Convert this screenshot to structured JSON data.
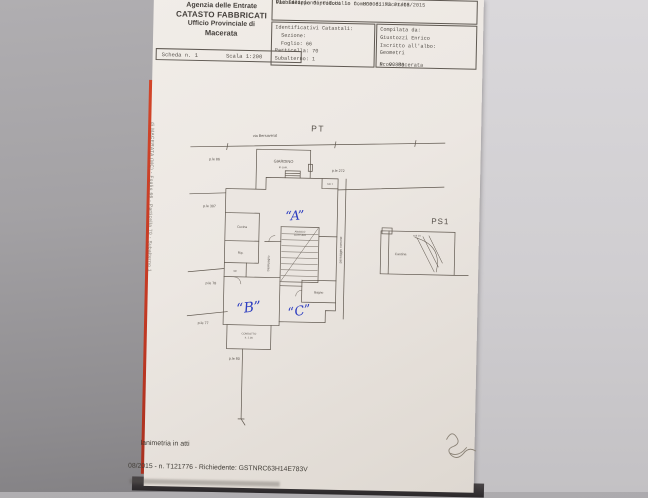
{
  "colors": {
    "red_folder": "#c43a24",
    "paper": "#ece7e2",
    "ink": "#56504a",
    "handwriting_blue": "#2c3dc0"
  },
  "header": {
    "agency": {
      "line1": "Agenzia delle Entrate",
      "line2": "CATASTO FABBRICATI",
      "line3": "Ufficio Provinciale di",
      "line4": "Macerata"
    },
    "scheda": {
      "sheet": "Scheda n. 1",
      "scale": "Scala 1:200"
    },
    "protocol": {
      "line1": "Dichiarazione protocollo n. MC0061173  21/08/2015",
      "line2": "Planimetria di U.I.U. in Comune di Macerata",
      "line3": "Via Filippo Corridoni",
      "variant": "var. 4"
    },
    "catasto": {
      "title": "Identificativi Catastali:",
      "sezione": "Sezione:",
      "foglio": "Foglio: 66",
      "particella": "Particella: 70",
      "subalterno": "Subalterno: 1"
    },
    "compiler": {
      "compilata": "Compilata da:",
      "name": "Giustozzi Enrico",
      "iscritto": "Iscritto all'albo:",
      "albo": "Geometri",
      "prov": "Prov. Macerata",
      "num": "N. 00800"
    }
  },
  "plan": {
    "pt": "PT",
    "ps1": "PS1",
    "street": "via Bersaverat",
    "giardino": "GIARDINO",
    "giardino_note": "in com.",
    "parcels": [
      "p.le 86",
      "p.le 272",
      "p.le 307",
      "p.le 78",
      "p.le 77",
      "p.le 80"
    ],
    "rooms": {
      "cucina": "Cucina",
      "rip": "Rip.",
      "wc": "wc",
      "disimpegno": "Disimpegno",
      "angolo_line1": "ANGOLO",
      "angolo_line2": "COTTURA",
      "bagno": "Bagno",
      "condotto_line1": "CONDOTTO",
      "condotto_line2": "h. 1.00",
      "cantina": "Cantina",
      "sub_small": "sub 1",
      "sub_ps1": "sub 10",
      "passaggio": "passaggio comune"
    },
    "marks": {
      "a": "“A”",
      "b": "“B”",
      "c": "“C”"
    }
  },
  "edge_note": "di MACERATA (MC) - Foglio 66 - Particella 70 - Subalterno 1",
  "footer": {
    "line1": "lanimetria in atti",
    "line2": "08/2015 - n. T121776 - Richiedente: GSTNRC63H14E783V"
  }
}
